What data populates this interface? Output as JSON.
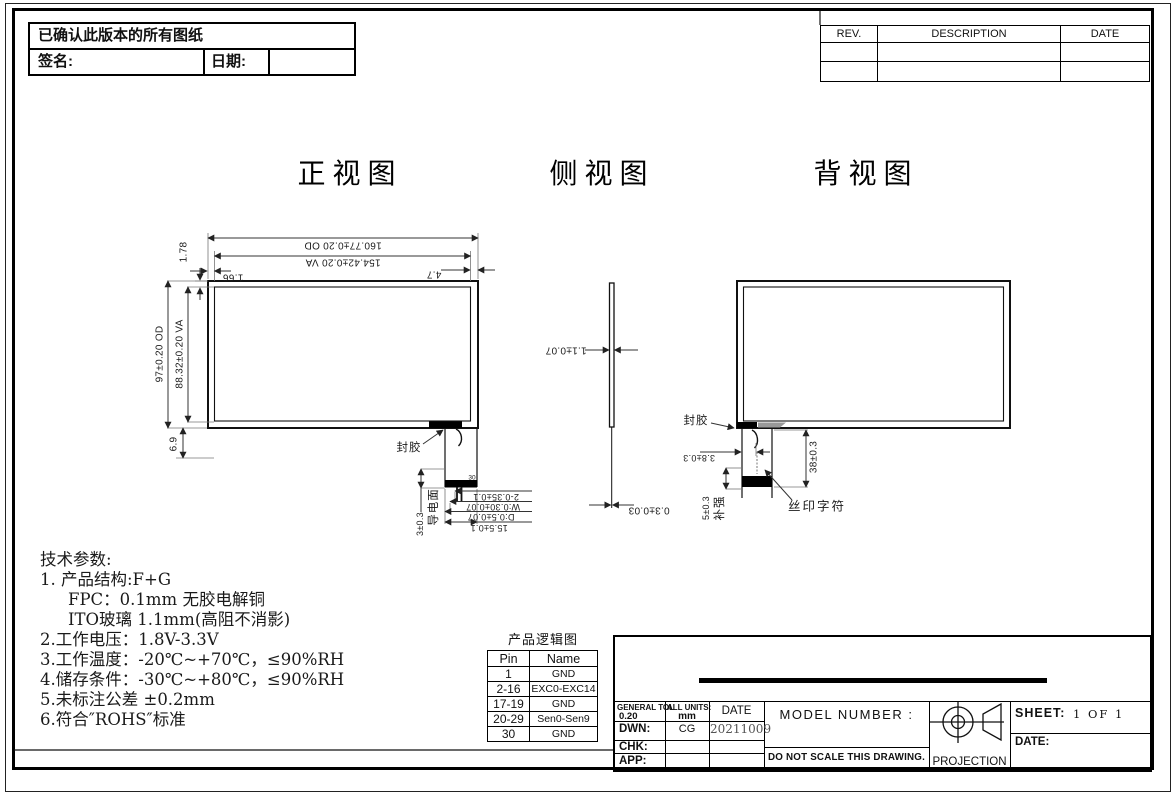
{
  "header_note": {
    "confirm": "已确认此版本的所有图纸",
    "sign_label": "签名:",
    "date_label": "日期:"
  },
  "rev_table": {
    "col_rev": "REV.",
    "col_description": "DESCRIPTION",
    "col_date": "DATE"
  },
  "views": {
    "front_title": "正视图",
    "side_title": "侧视图",
    "back_title": "背视图"
  },
  "front": {
    "dim_od_width": "160.77±0.20 OD",
    "dim_va_width": "154.42±0.20 VA",
    "dim_top_margin": "1.78",
    "dim_left_margin": "1.66",
    "dim_right_margin": "4.7",
    "dim_od_height": "97±0.20 OD",
    "dim_va_height": "88.32±0.20 VA",
    "dim_bottom": "6.9",
    "label_seal": "封胶",
    "label_pin30": "30",
    "label_conductive": "导电面",
    "dim_tail_offset": "3±0.3",
    "dim_pitch": "2-0.35±0.1",
    "dim_trace_w": "W:0.30±0.07",
    "dim_trace_d": "D:0.5±0.07",
    "dim_tail_width": "15.5±0.1"
  },
  "side": {
    "dim_glass": "1.1±0.07",
    "dim_fpc": "0.3±0.03"
  },
  "back": {
    "label_seal": "封胶",
    "dim_hook": "3.8±0.3",
    "dim_tail_len": "38±0.3",
    "dim_stiffener": "5±0.3",
    "label_stiffener": "补强",
    "label_silkscreen": "丝印字符"
  },
  "tech": {
    "title": "技术参数:",
    "lines": [
      "1. 产品结构:F+G",
      "FPC：0.1mm 无胶电解铜",
      "ITO玻璃 1.1mm(高阻不消影)",
      "2.工作电压：1.8V-3.3V",
      "3.工作温度：-20℃~+70℃，≤90%RH",
      "4.储存条件：-30℃~+80℃，≤90%RH",
      "5.未标注公差 ±0.2mm",
      "6.符合″ROHS″标准"
    ]
  },
  "logic_table": {
    "title": "产品逻辑图",
    "col_pin": "Pin",
    "col_name": "Name",
    "rows": [
      [
        "1",
        "GND"
      ],
      [
        "2-16",
        "EXC0-EXC14"
      ],
      [
        "17-19",
        "GND"
      ],
      [
        "20-29",
        "Sen0-Sen9"
      ],
      [
        "30",
        "GND"
      ]
    ]
  },
  "title_block": {
    "general_tol_label": "GENERAL TOL",
    "general_tol_value": "0.20",
    "units_label": "ALL UNITS:",
    "units_value": "mm",
    "date_header": "DATE",
    "dwn_label": "DWN:",
    "dwn_value": "CG",
    "dwn_date": "20211009",
    "chk_label": "CHK:",
    "app_label": "APP:",
    "model_number_label": "MODEL NUMBER :",
    "no_scale_note": "DO NOT SCALE THIS DRAWING.",
    "projection_label": "PROJECTION",
    "sheet_label": "SHEET:",
    "sheet_value": "1 OF 1",
    "date_label": "DATE:"
  }
}
